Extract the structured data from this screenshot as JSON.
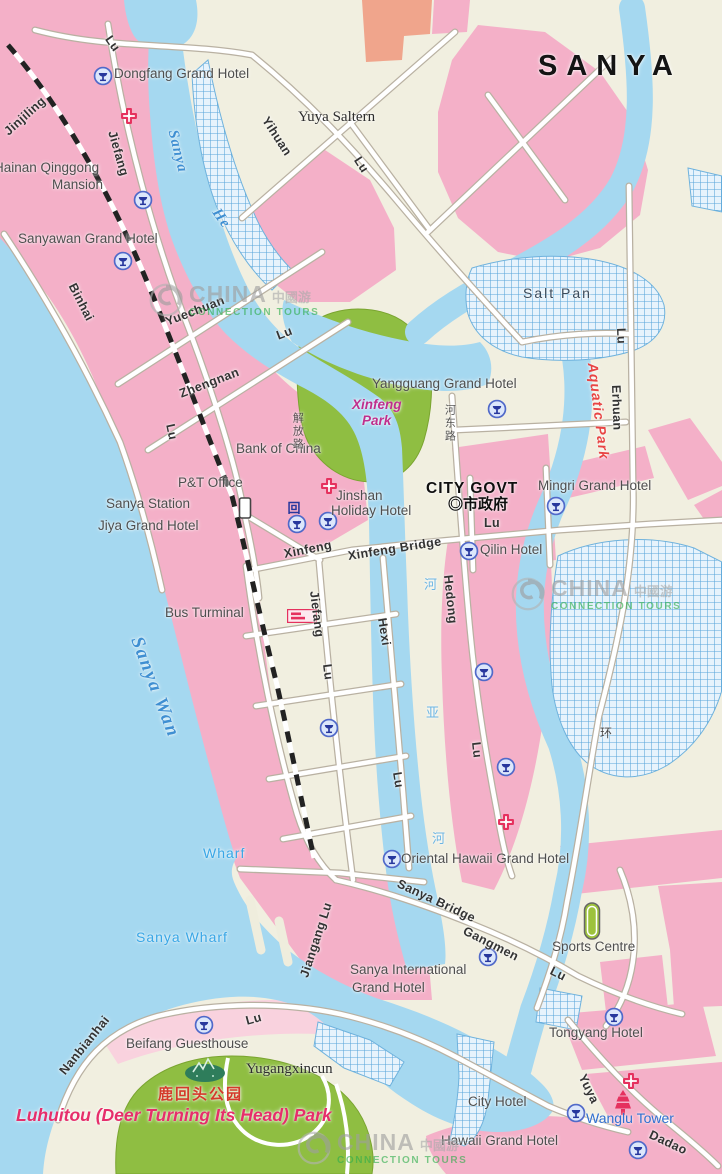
{
  "title": {
    "text": "SANYA"
  },
  "watermark": {
    "brand": "CHINA",
    "brand_cn": "中國游",
    "tagline": "CONNECTION TOURS"
  },
  "watermark_positions": [
    {
      "x": 148,
      "y": 282
    },
    {
      "x": 510,
      "y": 576
    },
    {
      "x": 296,
      "y": 1130
    }
  ],
  "colors": {
    "sea": "#a5d8f0",
    "land": "#f1efe0",
    "pink": "#f4b0c8",
    "pinkLight": "#f9d2de",
    "salmon": "#f0a58c",
    "green": "#8fbe42",
    "hatchLine": "#58a6da",
    "hatchBg": "#e7f3fc",
    "roadCase": "#b9b1a2",
    "roadFill": "#ffffff",
    "railway": "#222222",
    "accentRed": "#e5315e",
    "hotelBlue": "#27379d"
  },
  "labels": [
    {
      "id": "sanya-title",
      "t": "SANYA",
      "x": 538,
      "y": 50,
      "rot": 0,
      "cls": "title"
    },
    {
      "id": "dongfang-grand-hotel",
      "t": "Dongfang Grand Hotel",
      "x": 114,
      "y": 66,
      "rot": 0,
      "cls": ""
    },
    {
      "id": "yuya-saltern",
      "t": "Yuya Saltern",
      "x": 298,
      "y": 109,
      "rot": 0,
      "cls": "serif"
    },
    {
      "id": "jinjiling-road",
      "t": "Jinjiling",
      "x": 6,
      "y": 126,
      "rot": -42,
      "cls": "road"
    },
    {
      "id": "jiefang-lu-top",
      "t": "Lu",
      "x": 108,
      "y": 30,
      "rot": 55,
      "cls": "road"
    },
    {
      "id": "jiefang-upper",
      "t": "Jiefang",
      "x": 112,
      "y": 124,
      "rot": 74,
      "cls": "road"
    },
    {
      "id": "sanya-he-name",
      "t": "Sanya",
      "x": 172,
      "y": 122,
      "rot": 76,
      "cls": "water-it"
    },
    {
      "id": "sanya-he-name-2",
      "t": "He",
      "x": 215,
      "y": 202,
      "rot": 55,
      "cls": "water-it"
    },
    {
      "id": "yihuan-road",
      "t": "Yihuan",
      "x": 265,
      "y": 111,
      "rot": 57,
      "cls": "road"
    },
    {
      "id": "yihuan-lu",
      "t": "Lu",
      "x": 357,
      "y": 151,
      "rot": 57,
      "cls": "road"
    },
    {
      "id": "hainan-qinggong",
      "t": "Hainan Qinggong",
      "x": -6,
      "y": 160,
      "rot": 0,
      "cls": ""
    },
    {
      "id": "hainan-qinggong-2",
      "t": "Mansion",
      "x": 52,
      "y": 177,
      "rot": 0,
      "cls": ""
    },
    {
      "id": "sanyawan-grand-hotel",
      "t": "Sanyawan Grand Hotel",
      "x": 18,
      "y": 231,
      "rot": 0,
      "cls": ""
    },
    {
      "id": "binhai-road",
      "t": "Binhai",
      "x": 72,
      "y": 277,
      "rot": 63,
      "cls": "road"
    },
    {
      "id": "yuechuan-road",
      "t": "Yuechuan",
      "x": 166,
      "y": 315,
      "rot": -21,
      "cls": "road"
    },
    {
      "id": "yuechuan-lu",
      "t": "Lu",
      "x": 277,
      "y": 329,
      "rot": -21,
      "cls": "road"
    },
    {
      "id": "zhengnan-road",
      "t": "Zhengnan",
      "x": 180,
      "y": 387,
      "rot": -21,
      "cls": "road"
    },
    {
      "id": "lu-west",
      "t": "Lu",
      "x": 170,
      "y": 417,
      "rot": 78,
      "cls": "road"
    },
    {
      "id": "salt-pan-north",
      "t": "Salt Pan",
      "x": 523,
      "y": 286,
      "rot": 0,
      "cls": "saltpan"
    },
    {
      "id": "aquatic-park",
      "t": "Aquatic Park",
      "x": 592,
      "y": 355,
      "rot": 83,
      "cls": "aquatic"
    },
    {
      "id": "erhuan-lu",
      "t": "Lu",
      "x": 621,
      "y": 321,
      "rot": 88,
      "cls": "road"
    },
    {
      "id": "erhuan-road",
      "t": "Erhuan",
      "x": 616,
      "y": 378,
      "rot": 88,
      "cls": "road"
    },
    {
      "id": "xinfeng-park-1",
      "t": "Xinfeng",
      "x": 352,
      "y": 397,
      "rot": 0,
      "cls": "park-mag"
    },
    {
      "id": "xinfeng-park-2",
      "t": "Park",
      "x": 362,
      "y": 413,
      "rot": 0,
      "cls": "park-mag"
    },
    {
      "id": "yangguang-grand-hotel",
      "t": "Yangguang Grand Hotel",
      "x": 372,
      "y": 376,
      "rot": 0,
      "cls": ""
    },
    {
      "id": "bank-of-china",
      "t": "Bank of China",
      "x": 236,
      "y": 441,
      "rot": 0,
      "cls": ""
    },
    {
      "id": "pt-office",
      "t": "P&T Office",
      "x": 178,
      "y": 475,
      "rot": 0,
      "cls": ""
    },
    {
      "id": "sanya-station",
      "t": "Sanya Station",
      "x": 106,
      "y": 496,
      "rot": 0,
      "cls": ""
    },
    {
      "id": "jiya-grand-hotel",
      "t": "Jiya Grand Hotel",
      "x": 98,
      "y": 518,
      "rot": 0,
      "cls": ""
    },
    {
      "id": "jinshan-1",
      "t": "Jinshan",
      "x": 336,
      "y": 488,
      "rot": 0,
      "cls": ""
    },
    {
      "id": "jinshan-2",
      "t": "Holiday Hotel",
      "x": 331,
      "y": 503,
      "rot": 0,
      "cls": ""
    },
    {
      "id": "city-govt",
      "t": "CITY GOVT",
      "x": 426,
      "y": 480,
      "rot": 0,
      "cls": "govt"
    },
    {
      "id": "city-govt-cn",
      "t": "◎市政府",
      "x": 448,
      "y": 497,
      "rot": 0,
      "cls": "govt-cn"
    },
    {
      "id": "mingri-grand-hotel",
      "t": "Mingri Grand Hotel",
      "x": 538,
      "y": 478,
      "rot": 0,
      "cls": ""
    },
    {
      "id": "xinfeng-street",
      "t": "Xinfeng",
      "x": 284,
      "y": 547,
      "rot": -11,
      "cls": "road"
    },
    {
      "id": "xinfeng-bridge",
      "t": "Xinfeng Bridge",
      "x": 348,
      "y": 549,
      "rot": -9,
      "cls": "road"
    },
    {
      "id": "xinfeng-lu",
      "t": "Lu",
      "x": 484,
      "y": 516,
      "rot": 0,
      "cls": "road"
    },
    {
      "id": "qilin-hotel",
      "t": "Qilin Hotel",
      "x": 480,
      "y": 542,
      "rot": 0,
      "cls": ""
    },
    {
      "id": "hedong-lu-cn",
      "t": "河东路",
      "x": 443,
      "y": 404,
      "rot": 0,
      "cls": "cn-vert"
    },
    {
      "id": "hedong-road",
      "t": "Hedong",
      "x": 448,
      "y": 568,
      "rot": 84,
      "cls": "road"
    },
    {
      "id": "hedong-lu",
      "t": "Lu",
      "x": 476,
      "y": 735,
      "rot": 84,
      "cls": "road"
    },
    {
      "id": "jiefang-lu-cn",
      "t": "解放路",
      "x": 291,
      "y": 412,
      "rot": 0,
      "cls": "cn-vert"
    },
    {
      "id": "bus-terminal",
      "t": "Bus Turminal",
      "x": 165,
      "y": 605,
      "rot": 0,
      "cls": ""
    },
    {
      "id": "sanya-wan",
      "t": "Sanya Wan",
      "x": 136,
      "y": 627,
      "rot": 69,
      "cls": "water-big"
    },
    {
      "id": "jiefang-lower",
      "t": "Jiefang",
      "x": 314,
      "y": 584,
      "rot": 83,
      "cls": "road"
    },
    {
      "id": "jiefang-lower-lu",
      "t": "Lu",
      "x": 327,
      "y": 657,
      "rot": 83,
      "cls": "road"
    },
    {
      "id": "hexi-road",
      "t": "Hexi",
      "x": 382,
      "y": 611,
      "rot": 81,
      "cls": "road"
    },
    {
      "id": "hexi-lu",
      "t": "Lu",
      "x": 397,
      "y": 765,
      "rot": 81,
      "cls": "road"
    },
    {
      "id": "huan-cn",
      "t": "环",
      "x": 600,
      "y": 727,
      "rot": 0,
      "cls": "cn-sm"
    },
    {
      "id": "he-cn",
      "t": "河",
      "x": 424,
      "y": 578,
      "rot": 0,
      "cls": "cn-water"
    },
    {
      "id": "ya-cn",
      "t": "亚",
      "x": 426,
      "y": 706,
      "rot": 0,
      "cls": "cn-water"
    },
    {
      "id": "he-cn-2",
      "t": "河",
      "x": 432,
      "y": 832,
      "rot": 0,
      "cls": "cn-water"
    },
    {
      "id": "wharf",
      "t": "Wharf",
      "x": 203,
      "y": 846,
      "rot": 0,
      "cls": "water-sans"
    },
    {
      "id": "sanya-wharf",
      "t": "Sanya Wharf",
      "x": 136,
      "y": 930,
      "rot": 0,
      "cls": "water-sans"
    },
    {
      "id": "oriental-hawaii-grand-hotel",
      "t": "Oriental Hawaii Grand Hotel",
      "x": 401,
      "y": 851,
      "rot": 0,
      "cls": ""
    },
    {
      "id": "sanya-bridge",
      "t": "Sanya Bridge",
      "x": 398,
      "y": 876,
      "rot": 25,
      "cls": "road"
    },
    {
      "id": "gangmen-road",
      "t": "Gangmen",
      "x": 464,
      "y": 923,
      "rot": 27,
      "cls": "road"
    },
    {
      "id": "gangmen-lu",
      "t": "Lu",
      "x": 551,
      "y": 963,
      "rot": 27,
      "cls": "road"
    },
    {
      "id": "jiangang-lu",
      "t": "Jiangang Lu",
      "x": 304,
      "y": 970,
      "rot": -72,
      "cls": "road"
    },
    {
      "id": "sports-centre",
      "t": "Sports Centre",
      "x": 552,
      "y": 939,
      "rot": 0,
      "cls": ""
    },
    {
      "id": "sanya-international-1",
      "t": "Sanya International",
      "x": 350,
      "y": 962,
      "rot": 0,
      "cls": ""
    },
    {
      "id": "sanya-international-2",
      "t": "Grand Hotel",
      "x": 352,
      "y": 980,
      "rot": 0,
      "cls": ""
    },
    {
      "id": "tongyang-hotel",
      "t": "Tongyang Hotel",
      "x": 549,
      "y": 1025,
      "rot": 0,
      "cls": ""
    },
    {
      "id": "nanbianhai-road",
      "t": "Nanbianhai",
      "x": 62,
      "y": 1066,
      "rot": -51,
      "cls": "road"
    },
    {
      "id": "nanbianhai-lu",
      "t": "Lu",
      "x": 246,
      "y": 1014,
      "rot": -15,
      "cls": "road"
    },
    {
      "id": "beifang-guesthouse",
      "t": "Beifang Guesthouse",
      "x": 126,
      "y": 1036,
      "rot": 0,
      "cls": ""
    },
    {
      "id": "yugangxincun",
      "t": "Yugangxincun",
      "x": 246,
      "y": 1061,
      "rot": 0,
      "cls": "serif"
    },
    {
      "id": "luhuitou-cn",
      "t": "鹿回头公园",
      "x": 158,
      "y": 1087,
      "rot": 0,
      "cls": "cn-red"
    },
    {
      "id": "luhuitou-park",
      "t": "Luhuitou (Deer Turning Its Head) Park",
      "x": 16,
      "y": 1106,
      "rot": 0,
      "cls": "park-red"
    },
    {
      "id": "city-hotel",
      "t": "City Hotel",
      "x": 468,
      "y": 1094,
      "rot": 0,
      "cls": ""
    },
    {
      "id": "wanglu-tower",
      "t": "Wanglu Tower",
      "x": 586,
      "y": 1111,
      "rot": 0,
      "cls": "blue-place"
    },
    {
      "id": "yuya-road",
      "t": "Yuya",
      "x": 582,
      "y": 1068,
      "rot": 64,
      "cls": "road"
    },
    {
      "id": "dadao-road",
      "t": "Dadao",
      "x": 650,
      "y": 1127,
      "rot": 25,
      "cls": "road"
    },
    {
      "id": "hawaii-grand-hotel",
      "t": "Hawaii Grand Hotel",
      "x": 441,
      "y": 1133,
      "rot": 0,
      "cls": ""
    }
  ],
  "icons": [
    {
      "type": "hotel-icon",
      "name": "hotel-marker-dongfang",
      "x": 103,
      "y": 76
    },
    {
      "type": "cross-icon",
      "name": "hospital-marker-jiefang",
      "x": 129,
      "y": 116
    },
    {
      "type": "hotel-icon",
      "name": "hotel-marker-hainan-qinggong",
      "x": 143,
      "y": 200
    },
    {
      "type": "hotel-icon",
      "name": "hotel-marker-sanyawan",
      "x": 123,
      "y": 261
    },
    {
      "type": "hotel-icon",
      "name": "hotel-marker-yangguang",
      "x": 497,
      "y": 409
    },
    {
      "type": "cross-icon",
      "name": "hospital-marker-jinshan",
      "x": 329,
      "y": 486
    },
    {
      "type": "station-icon",
      "name": "railway-station-marker",
      "x": 245,
      "y": 508
    },
    {
      "type": "landmark-icon",
      "name": "landmark-marker",
      "x": 294,
      "y": 508
    },
    {
      "type": "hotel-icon",
      "name": "hotel-marker-jiya",
      "x": 297,
      "y": 524
    },
    {
      "type": "hotel-icon",
      "name": "hotel-marker-jinshan",
      "x": 328,
      "y": 521
    },
    {
      "type": "hotel-icon",
      "name": "hotel-marker-mingri",
      "x": 556,
      "y": 506
    },
    {
      "type": "hotel-icon",
      "name": "hotel-marker-qilin",
      "x": 469,
      "y": 551
    },
    {
      "type": "bus-icon",
      "name": "bus-terminal-marker",
      "x": 302,
      "y": 616
    },
    {
      "type": "hotel-icon",
      "name": "hotel-marker-fudao",
      "x": 484,
      "y": 672
    },
    {
      "type": "hotel-icon",
      "name": "hotel-marker-haigang",
      "x": 329,
      "y": 728
    },
    {
      "type": "hotel-icon",
      "name": "hotel-marker-sanya-mansion",
      "x": 506,
      "y": 767
    },
    {
      "type": "cross-icon",
      "name": "hospital-marker-hedong",
      "x": 506,
      "y": 822
    },
    {
      "type": "hotel-icon",
      "name": "hotel-marker-oriental-hawaii",
      "x": 392,
      "y": 859
    },
    {
      "type": "stadium-icon",
      "name": "stadium-marker",
      "x": 592,
      "y": 921
    },
    {
      "type": "hotel-icon",
      "name": "hotel-marker-sanya-international",
      "x": 488,
      "y": 957
    },
    {
      "type": "hotel-icon",
      "name": "hotel-marker-tongyang",
      "x": 614,
      "y": 1017
    },
    {
      "type": "hotel-icon",
      "name": "hotel-marker-beifang",
      "x": 204,
      "y": 1025
    },
    {
      "type": "deer-icon",
      "name": "luhuitou-statue-marker",
      "x": 205,
      "y": 1070
    },
    {
      "type": "cross-icon",
      "name": "hospital-marker-wanglu",
      "x": 631,
      "y": 1081
    },
    {
      "type": "pagoda-icon",
      "name": "wanglu-tower-marker",
      "x": 623,
      "y": 1102
    },
    {
      "type": "hotel-icon",
      "name": "hotel-marker-city",
      "x": 576,
      "y": 1113
    },
    {
      "type": "hotel-icon",
      "name": "hotel-marker-hawaii",
      "x": 638,
      "y": 1150
    }
  ]
}
